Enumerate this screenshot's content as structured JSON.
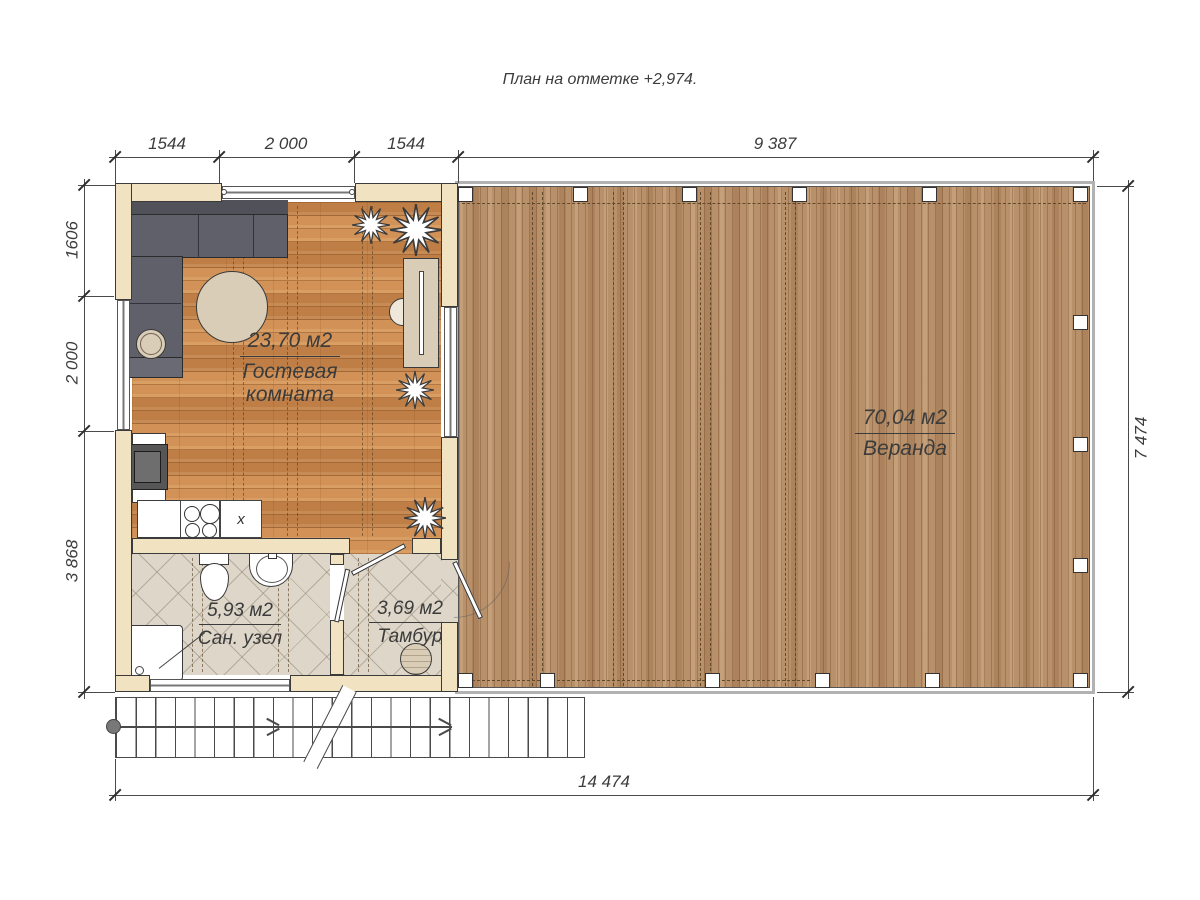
{
  "title": "План на отметке +2,974.",
  "dims": {
    "top": [
      "1544",
      "2 000",
      "1544",
      "9 387"
    ],
    "left": [
      "1606",
      "2 000",
      "3 868"
    ],
    "right": [
      "7 474"
    ],
    "bottom": [
      "14 474"
    ]
  },
  "rooms": {
    "guest": {
      "area": "23,70 м2",
      "name": "Гостевая комната"
    },
    "bath": {
      "area": "5,93 м2",
      "name": "Сан. узел"
    },
    "tambour": {
      "area": "3,69 м2",
      "name": "Тамбур"
    },
    "veranda": {
      "area": "70,04 м2",
      "name": "Веранда"
    }
  },
  "kitchen": {
    "sink_mark": "x"
  },
  "colors": {
    "wall": "#f1e3c2",
    "wood_room": "#c9894e",
    "wood_veranda": "#b8906a",
    "tile": "#ddd6c9",
    "sofa": "#60606a",
    "line": "#3a3a3a"
  }
}
